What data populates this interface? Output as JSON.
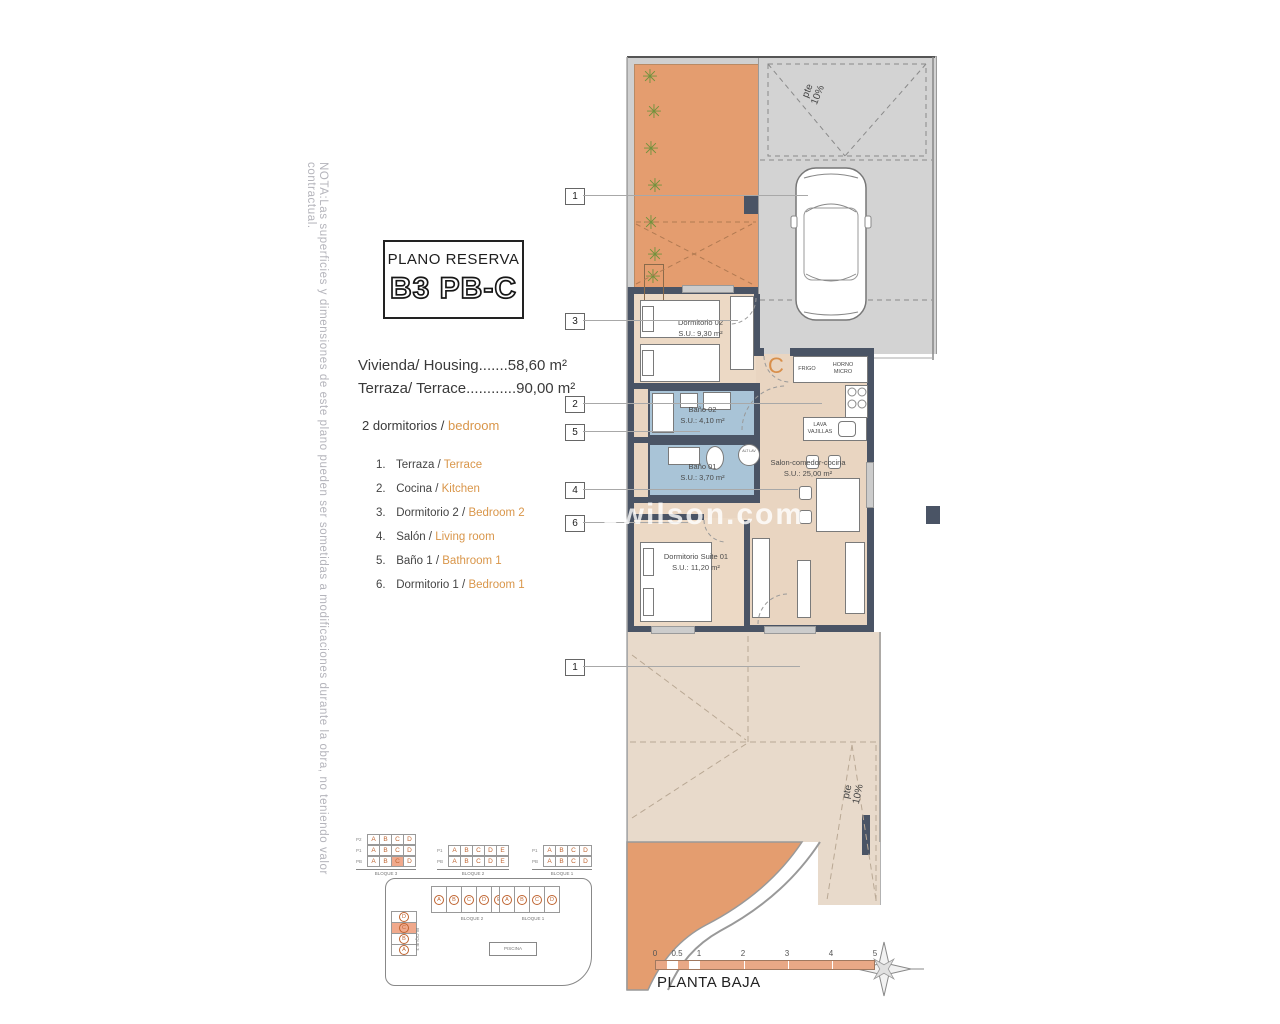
{
  "note": "NOTA:Las superficies y dimensiones de este plano pueden ser sometidas a modificaciones durante la obra, no teniendo valor contractual.",
  "title_block": {
    "title": "PLANO RESERVA",
    "code": "B3 PB-C"
  },
  "summary": {
    "housing": "Vivienda/ Housing.......58,60 m²",
    "terrace": "Terraza/ Terrace............90,00 m²",
    "bedrooms_prefix": "2 dormitorios /",
    "bedrooms_suffix": "bedroom"
  },
  "legend": {
    "items": [
      {
        "num": "1.",
        "es": "Terraza /",
        "en": "Terrace"
      },
      {
        "num": "2.",
        "es": "Cocina /",
        "en": "Kitchen"
      },
      {
        "num": "3.",
        "es": "Dormitorio 2 /",
        "en": "Bedroom 2"
      },
      {
        "num": "4.",
        "es": "Salón /",
        "en": "Living room"
      },
      {
        "num": "5.",
        "es": "Baño 1 /",
        "en": "Bathroom 1"
      },
      {
        "num": "6.",
        "es": "Dormitorio 1 /",
        "en": "Bedroom 1"
      }
    ]
  },
  "plan": {
    "rooms": {
      "dorm2": {
        "name": "Dormitorio 02",
        "area": "S.U.: 9,30 m²"
      },
      "bath2": {
        "name": "Baño 02",
        "area": "S.U.: 4,10 m²"
      },
      "bath1": {
        "name": "Baño 01",
        "area": "S.U.: 3,70 m²"
      },
      "salon": {
        "name": "Salon-comedor-cocina",
        "area": "S.U.: 25,00 m²"
      },
      "suite": {
        "name": "Dormitorio Suite 01",
        "area": "S.U.: 11,20 m²"
      }
    },
    "appliances": {
      "fridge": "FRIGO",
      "oven": "HORNO MICRO",
      "dishwasher": "LAVA VAJILLAS",
      "washer": "ALT LAV"
    },
    "entrance_letter": "C",
    "slope_top": "pte 10%",
    "slope_bottom": "pte 10%",
    "callouts": [
      {
        "label": "1"
      },
      {
        "label": "3"
      },
      {
        "label": "2"
      },
      {
        "label": "5"
      },
      {
        "label": "4"
      },
      {
        "label": "6"
      },
      {
        "label": "1"
      }
    ]
  },
  "unit_tables": [
    {
      "label": "BLOQUE 3",
      "rows": [
        {
          "name": "P2",
          "cells": [
            "A",
            "B",
            "C",
            "D"
          ],
          "highlight": -1
        },
        {
          "name": "P1",
          "cells": [
            "A",
            "B",
            "C",
            "D"
          ],
          "highlight": -1
        },
        {
          "name": "PB",
          "cells": [
            "A",
            "B",
            "C",
            "D"
          ],
          "highlight": 2
        }
      ]
    },
    {
      "label": "BLOQUE 2",
      "rows": [
        {
          "name": "P1",
          "cells": [
            "A",
            "B",
            "C",
            "D",
            "E"
          ],
          "highlight": -1
        },
        {
          "name": "PB",
          "cells": [
            "A",
            "B",
            "C",
            "D",
            "E"
          ],
          "highlight": -1
        }
      ]
    },
    {
      "label": "BLOQUE 1",
      "rows": [
        {
          "name": "P1",
          "cells": [
            "A",
            "B",
            "C",
            "D"
          ],
          "highlight": -1
        },
        {
          "name": "PB",
          "cells": [
            "A",
            "B",
            "C",
            "D"
          ],
          "highlight": -1
        }
      ]
    }
  ],
  "site_plan": {
    "bloque3": {
      "label": "BLOQUE 3",
      "units": [
        "D",
        "C",
        "B",
        "A"
      ],
      "highlight": 1
    },
    "bloque2": {
      "label": "BLOQUE 2",
      "units": [
        "A",
        "B",
        "C",
        "D",
        "E"
      ],
      "highlight": -1
    },
    "bloque1": {
      "label": "BLOQUE 1",
      "units": [
        "A",
        "B",
        "C",
        "D"
      ],
      "highlight": -1
    },
    "pool": "PISCINA"
  },
  "scale_bar": {
    "ticks": [
      "0",
      "0.5",
      "1",
      "2",
      "3",
      "4",
      "5"
    ],
    "caption": "PLANTA BAJA"
  },
  "watermark": "swilson.com",
  "colors": {
    "terrace_orange": "#e49d6f",
    "room_beige": "#e9d5c1",
    "bath_blue": "#a9c4d7",
    "wall_dark": "#4a5465",
    "driveway_gray": "#d3d3d3",
    "accent_orange": "#d9964a",
    "highlight_salmon": "#f0a98c"
  }
}
